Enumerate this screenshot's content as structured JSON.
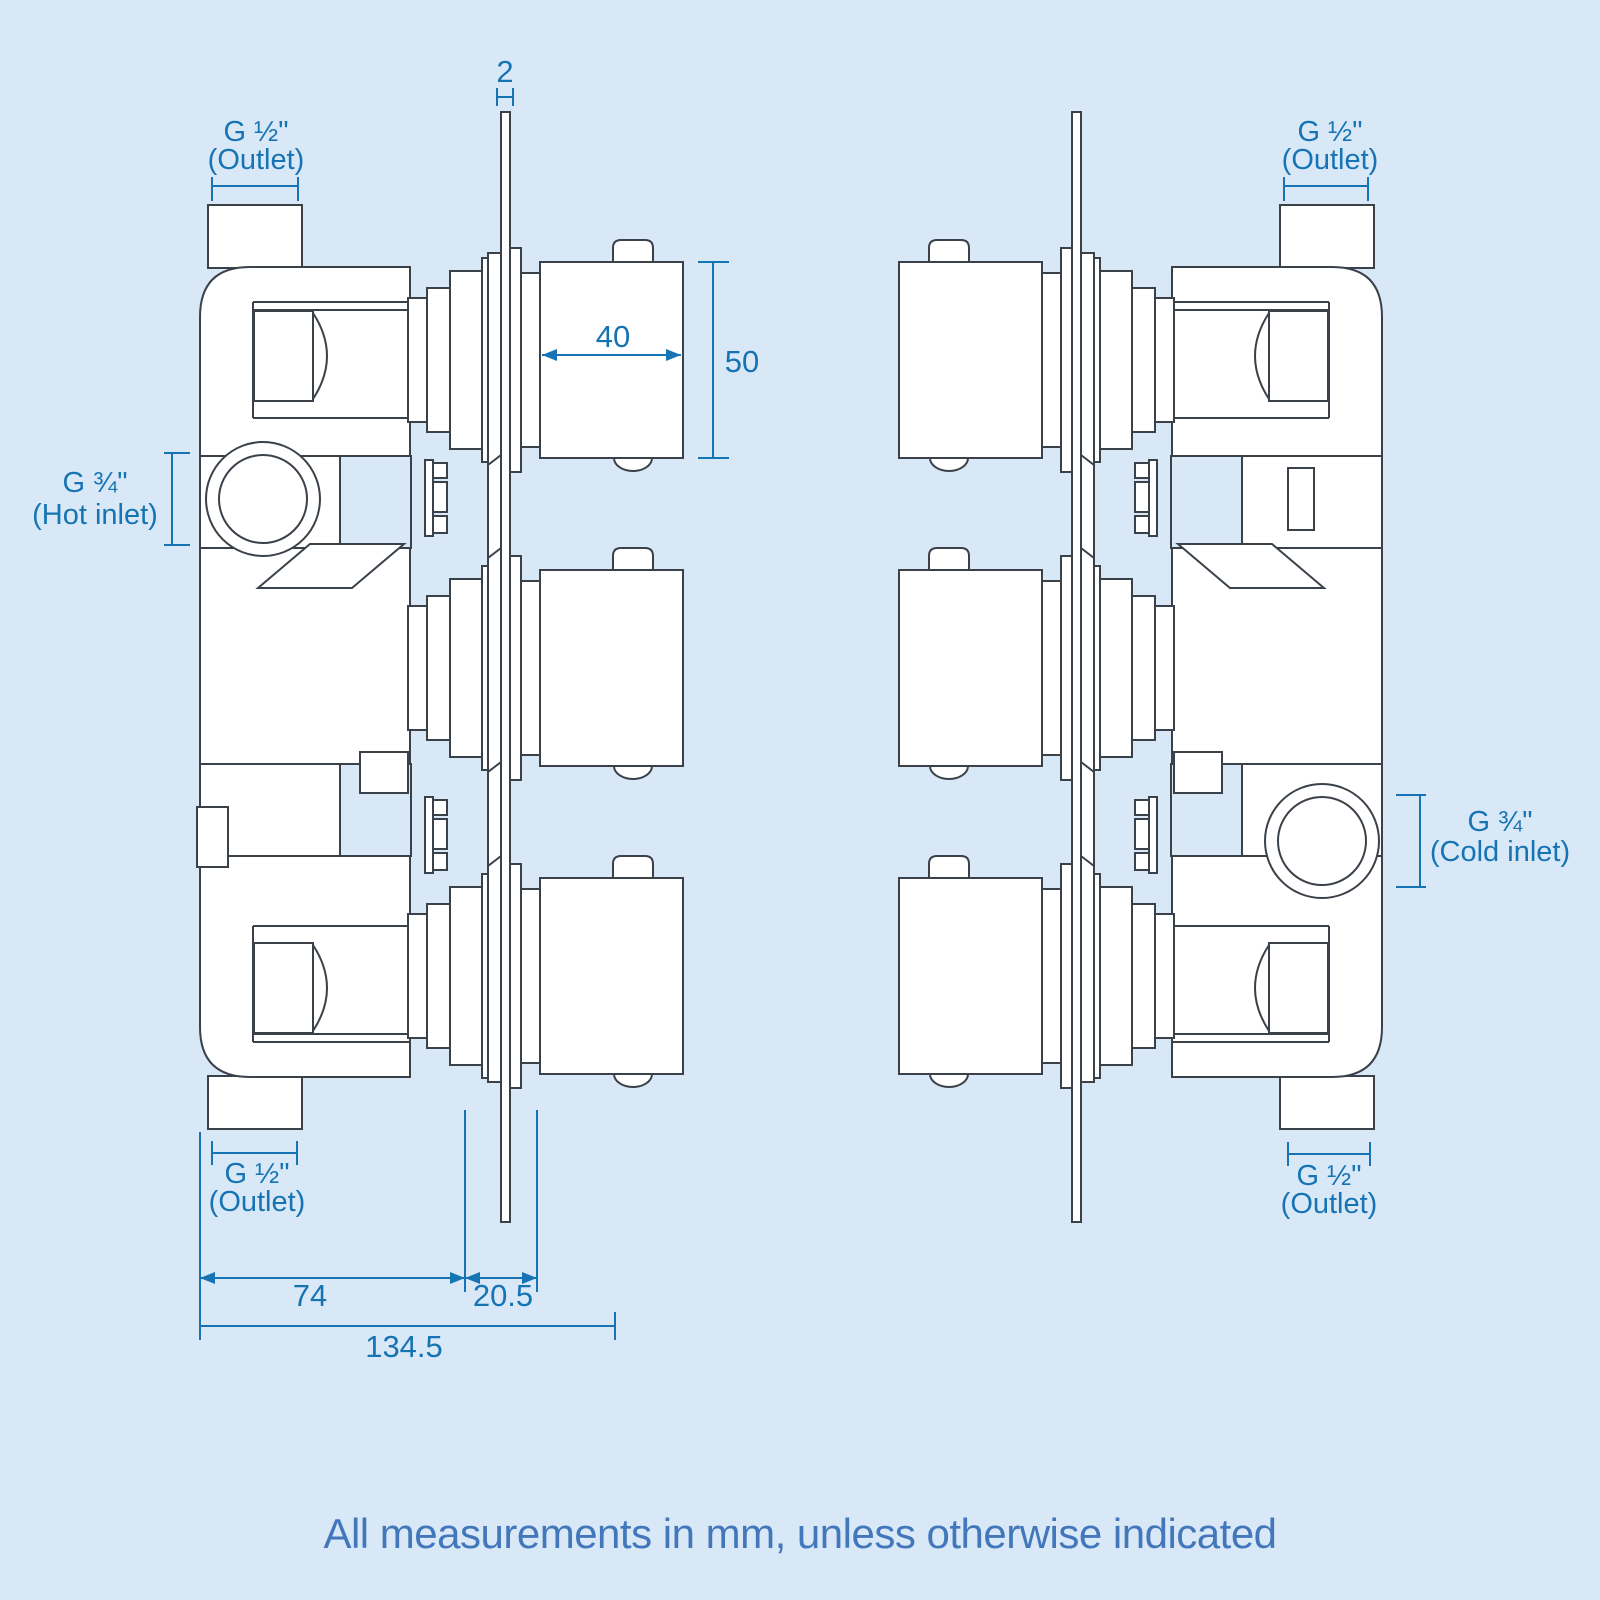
{
  "meta": {
    "colors": {
      "bg": "#d9e8f6",
      "line": "#3a4149",
      "dim": "#1674b4",
      "footer": "#4377bb"
    },
    "drawing_type": "thermostatic-shower-valve-dimension-diagram",
    "units_note_visible": true
  },
  "views": {
    "left": {
      "top_outlet": {
        "l1": "G ½\"",
        "l2": "(Outlet)"
      },
      "hot_inlet": {
        "l1": "G ¾\"",
        "l2": "(Hot inlet)"
      },
      "bottom_outlet": {
        "l1": "G ½\"",
        "l2": "(Outlet)"
      },
      "dims": {
        "plate_thickness": "2",
        "knob_width": "40",
        "knob_height": "50",
        "body_depth": "74",
        "plate_offset": "20.5",
        "total_depth": "134.5"
      }
    },
    "right": {
      "top_outlet": {
        "l1": "G ½\"",
        "l2": "(Outlet)"
      },
      "cold_inlet": {
        "l1": "G ¾\"",
        "l2": "(Cold inlet)"
      },
      "bottom_outlet": {
        "l1": "G ½\"",
        "l2": "(Outlet)"
      }
    }
  },
  "footer": {
    "note": "All measurements in mm, unless otherwise indicated"
  }
}
